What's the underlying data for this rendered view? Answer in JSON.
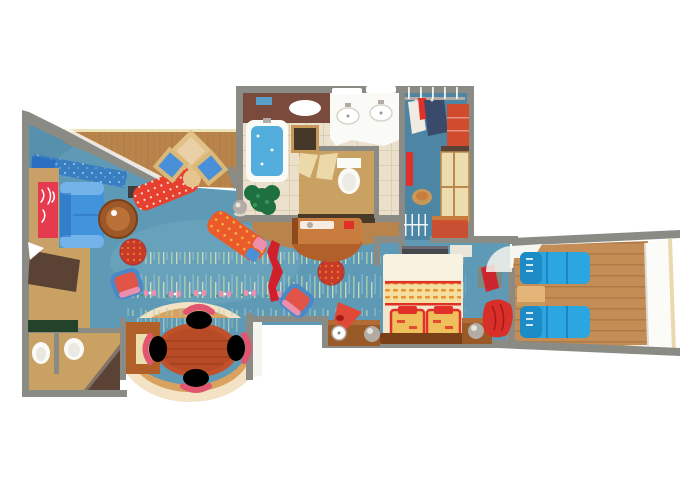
{
  "meta": {
    "title": "Cruise suite floor plan illustration",
    "type": "floor-plan-illustration",
    "width_px": 680,
    "height_px": 486,
    "visible_text": ""
  },
  "scene": {
    "rooms": [
      "living-room",
      "dining-bay",
      "powder-room",
      "desk-nook",
      "entry-hall",
      "bathroom",
      "toilet-compartment",
      "walk-in-closet",
      "bedroom",
      "private-balcony"
    ],
    "living_room_items": [
      "window-seat",
      "sideboard",
      "wall-art",
      "blue-sofa",
      "coffee-table",
      "red-chaise",
      "diamond-chairs",
      "diamond-table",
      "orange-lounger",
      "red-pouf",
      "accent-chair",
      "floor-lamp",
      "robe-stand",
      "flower-rug"
    ],
    "dining_bay_items": [
      "oval-dining-table",
      "four-pink-chairs",
      "bay-console"
    ],
    "bathroom_items": [
      "bathtub",
      "double-sink-vanity",
      "mirror",
      "ceiling-light",
      "toilet",
      "plant"
    ],
    "closet_items": [
      "hanging-rod",
      "clothes",
      "red-shelving",
      "cabinets",
      "stool",
      "shoe-rack"
    ],
    "bedroom_items": [
      "double-bed",
      "two-red-pillows",
      "headboard",
      "nightstands",
      "sphere-lamps",
      "cone-lamp",
      "alarm-clock",
      "tv-cabinet",
      "bench",
      "red-armchair",
      "balcony-door"
    ],
    "balcony_items": [
      "two-sun-loungers",
      "side-table",
      "deck-planks",
      "hull-edge",
      "open-door"
    ],
    "powder_room_items": [
      "toilet",
      "pedestal-sink",
      "shower-wall"
    ]
  },
  "palette": {
    "bg": "#ffffff",
    "wall": "#8b8b85",
    "wall_dark": "#6e6e68",
    "wall_face": "#f4f4f1",
    "carpet": "#5e9ab6",
    "carpet_dark": "#4d86a4",
    "carpet_light": "#79aec4",
    "streak_green": "#bcd9a8",
    "streak_yellow": "#e3e6bd",
    "streak_blue": "#9fc9d8",
    "wood": "#b9834c",
    "wood_dark": "#96632f",
    "wood_light": "#d3a264",
    "bay_floor": "#c78b4e",
    "bay_band": "#f3e2c4",
    "bay_band_inner": "#d9a35f",
    "deck": "#c38d55",
    "deck_line": "#9c6a38",
    "hull": "#fbfbf8",
    "hull_shadow": "#dcdcd4",
    "hull_line": "#e8d2a0",
    "railing": "#ece4b8",
    "tile": "#eae0cb",
    "tile_line": "#d5c7a9",
    "bath_wall_brown": "#7a4a3c",
    "water": "#53aede",
    "white_fixture": "#fafaf7",
    "fixture_shadow": "#d8d4c8",
    "sofa": "#4193dc",
    "sofa_dark": "#2a6fc0",
    "sofa_light": "#74b2ea",
    "seat_blue": "#3a7ec2",
    "sparkle": "#a8d8f0",
    "art_red": "#e63a4e",
    "sideboard": "#c9a068",
    "table_wood": "#9c5828",
    "table_wood_dark": "#7a3f14",
    "chaise_red": "#e8402e",
    "pillow_tan": "#e6c48e",
    "frame_tan": "#d9b878",
    "cushion_blue": "#4a90d8",
    "diamond_table": "#e2c188",
    "lounger_orange": "#ea5a2a",
    "dot_yellow": "#f2c443",
    "pouf_red": "#c83a28",
    "pouf_dot": "#ea7a32",
    "chair_frame_blue": "#4a88c8",
    "chair_cushion_red": "#e05548",
    "chair_pink": "#ec8fae",
    "chair_pink_dark": "#e05570",
    "robe_red": "#d2202a",
    "console_wood": "#b06028",
    "console_wood_light": "#c87c3e",
    "console_wood_dark": "#8f4a1c",
    "plant_green": "#1e7040",
    "plant_green_light": "#35985a",
    "desk_brown": "#5a4334",
    "counter_green": "#23422a",
    "nook_floor": "#c9a163",
    "closet_red": "#d04c2c",
    "closet_cabinet": "#eddcae",
    "closet_cabinet_frame": "#b98a50",
    "stool_tan": "#c89858",
    "dining_table": "#c0512a",
    "dining_table_dark": "#9a3a1a",
    "bed_cream": "#f2e7cc",
    "bed_white": "#f8f2e0",
    "bed_stripe_bg": "#f5dfa0",
    "bed_stripe": "#e8912f",
    "bed_trim": "#e03028",
    "pillow_gold": "#eebf5a",
    "headboard": "#7a4018",
    "nightstand": "#9a5a28",
    "nightstand_top": "#b06c34",
    "lamp_red": "#e04838",
    "silver": "#b3aca4",
    "silver_light": "#e8e4de",
    "tv_cabinet": "#474750",
    "tv_cabinet_top": "#6a6a74",
    "bench": "#e9e5d8",
    "chair_red": "#d83028",
    "chair_red_dark": "#a81818",
    "balcony_lounger": "#2ba6e0",
    "balcony_lounger_dark": "#1b86c0",
    "balcony_table": "#e3b578",
    "door_white": "#f6f6f0",
    "dark_doorway": "#4a3828",
    "clothes_navy": "#3a4a6a",
    "clothes_white": "#f0ece4",
    "mirror_dark": "#463828",
    "slot_dark": "#3a3430"
  }
}
